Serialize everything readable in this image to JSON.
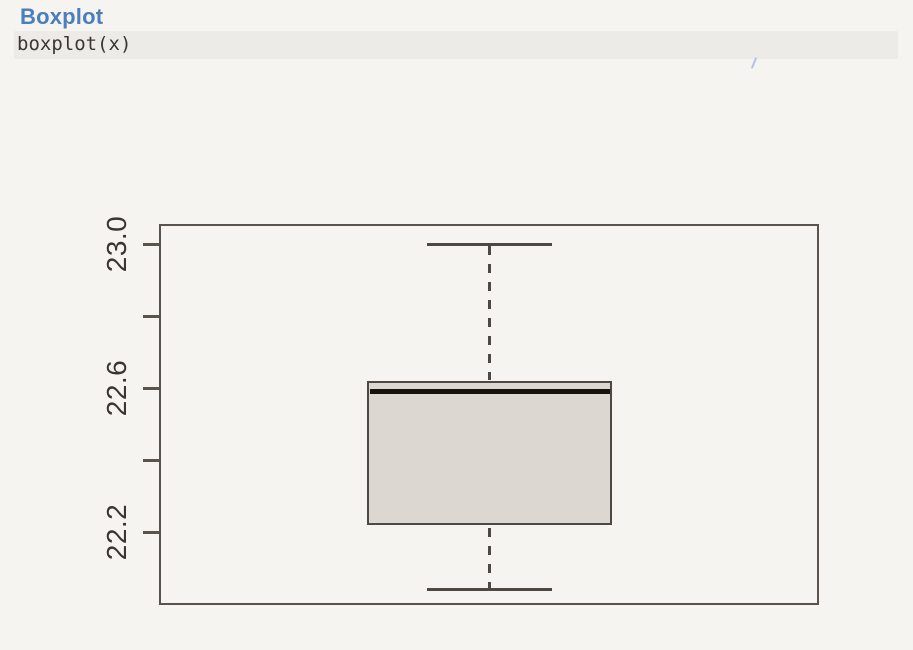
{
  "page": {
    "title": "Boxplot",
    "code": "boxplot(x)"
  },
  "colors": {
    "page_background": "#f6f4f0",
    "heading_text": "#4a7ebc",
    "code_background": "#edebe7",
    "code_text": "#3a3733",
    "plot_frame": "#59534c",
    "axis_text": "#3b3531",
    "box_border": "#4e4842",
    "box_fill": "#dcd8d1",
    "median_line": "#16120e",
    "whisker": "#4e4842",
    "artifact_blue": "#8fa8d8"
  },
  "chart_data": {
    "type": "boxplot",
    "orientation": "vertical",
    "title": "",
    "xlabel": "",
    "ylabel": "",
    "series": [
      {
        "name": "x",
        "stats": {
          "min": 22.04,
          "q1": 22.22,
          "median": 22.59,
          "q3": 22.62,
          "max": 23.0
        },
        "outliers": []
      }
    ],
    "ylim": [
      22.0,
      23.05
    ],
    "yticks": [
      {
        "value": 23.0,
        "label": "23.0"
      },
      {
        "value": 22.8,
        "label": ""
      },
      {
        "value": 22.6,
        "label": "22.6"
      },
      {
        "value": 22.4,
        "label": ""
      },
      {
        "value": 22.2,
        "label": "22.2"
      }
    ],
    "grid": false,
    "legend": false
  }
}
